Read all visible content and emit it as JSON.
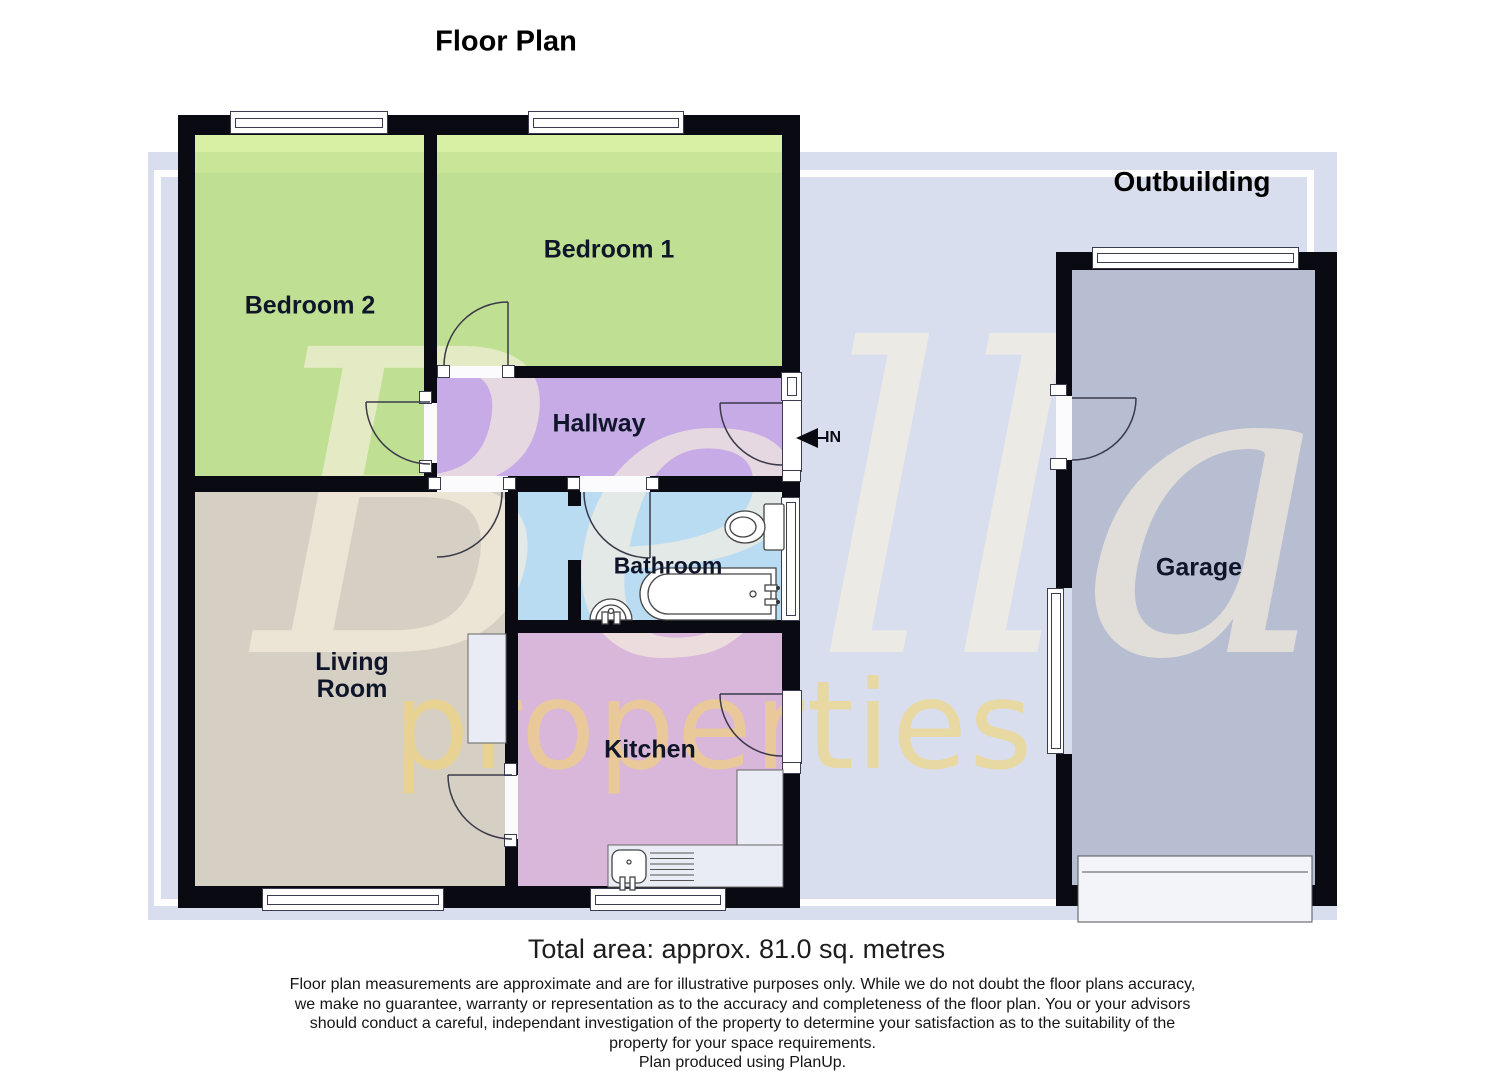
{
  "page": {
    "title": "Floor Plan"
  },
  "plan": {
    "rooms": {
      "bedroom2": "Bedroom 2",
      "bedroom1": "Bedroom 1",
      "hallway": "Hallway",
      "bathroom": "Bathroom",
      "living_line1": "Living",
      "living_line2": "Room",
      "kitchen": "Kitchen",
      "garage": "Garage"
    },
    "outbuilding_label": "Outbuilding",
    "entrance_label": "IN",
    "watermark": {
      "primary": "Bella",
      "secondary": "properties"
    },
    "colors": {
      "bedroom_fill": "#bfe092",
      "hallway_fill": "#c7abe6",
      "bathroom_fill": "#badcf2",
      "kitchen_fill": "#d9b7da",
      "living_fill": "#d6d0c4",
      "garage_fill": "#b7bed2",
      "wall": "#0a0a12",
      "background_panel": "#d8deee",
      "watermark_primary": "#f2e8d8",
      "watermark_secondary": "#f2d378"
    }
  },
  "footer": {
    "total_area": "Total area: approx. 81.0 sq. metres",
    "disclaimer_line1": "Floor plan measurements are approximate and are for illustrative purposes only. While we do not doubt the floor plans accuracy,",
    "disclaimer_line2": "we make no guarantee, warranty or representation as to the accuracy and completeness of the floor plan. You or your advisors",
    "disclaimer_line3": "should conduct a careful, independant investigation of the property to determine your satisfaction as to the suitability of the",
    "disclaimer_line4": "property for your space requirements.",
    "credit": "Plan produced using PlanUp."
  }
}
